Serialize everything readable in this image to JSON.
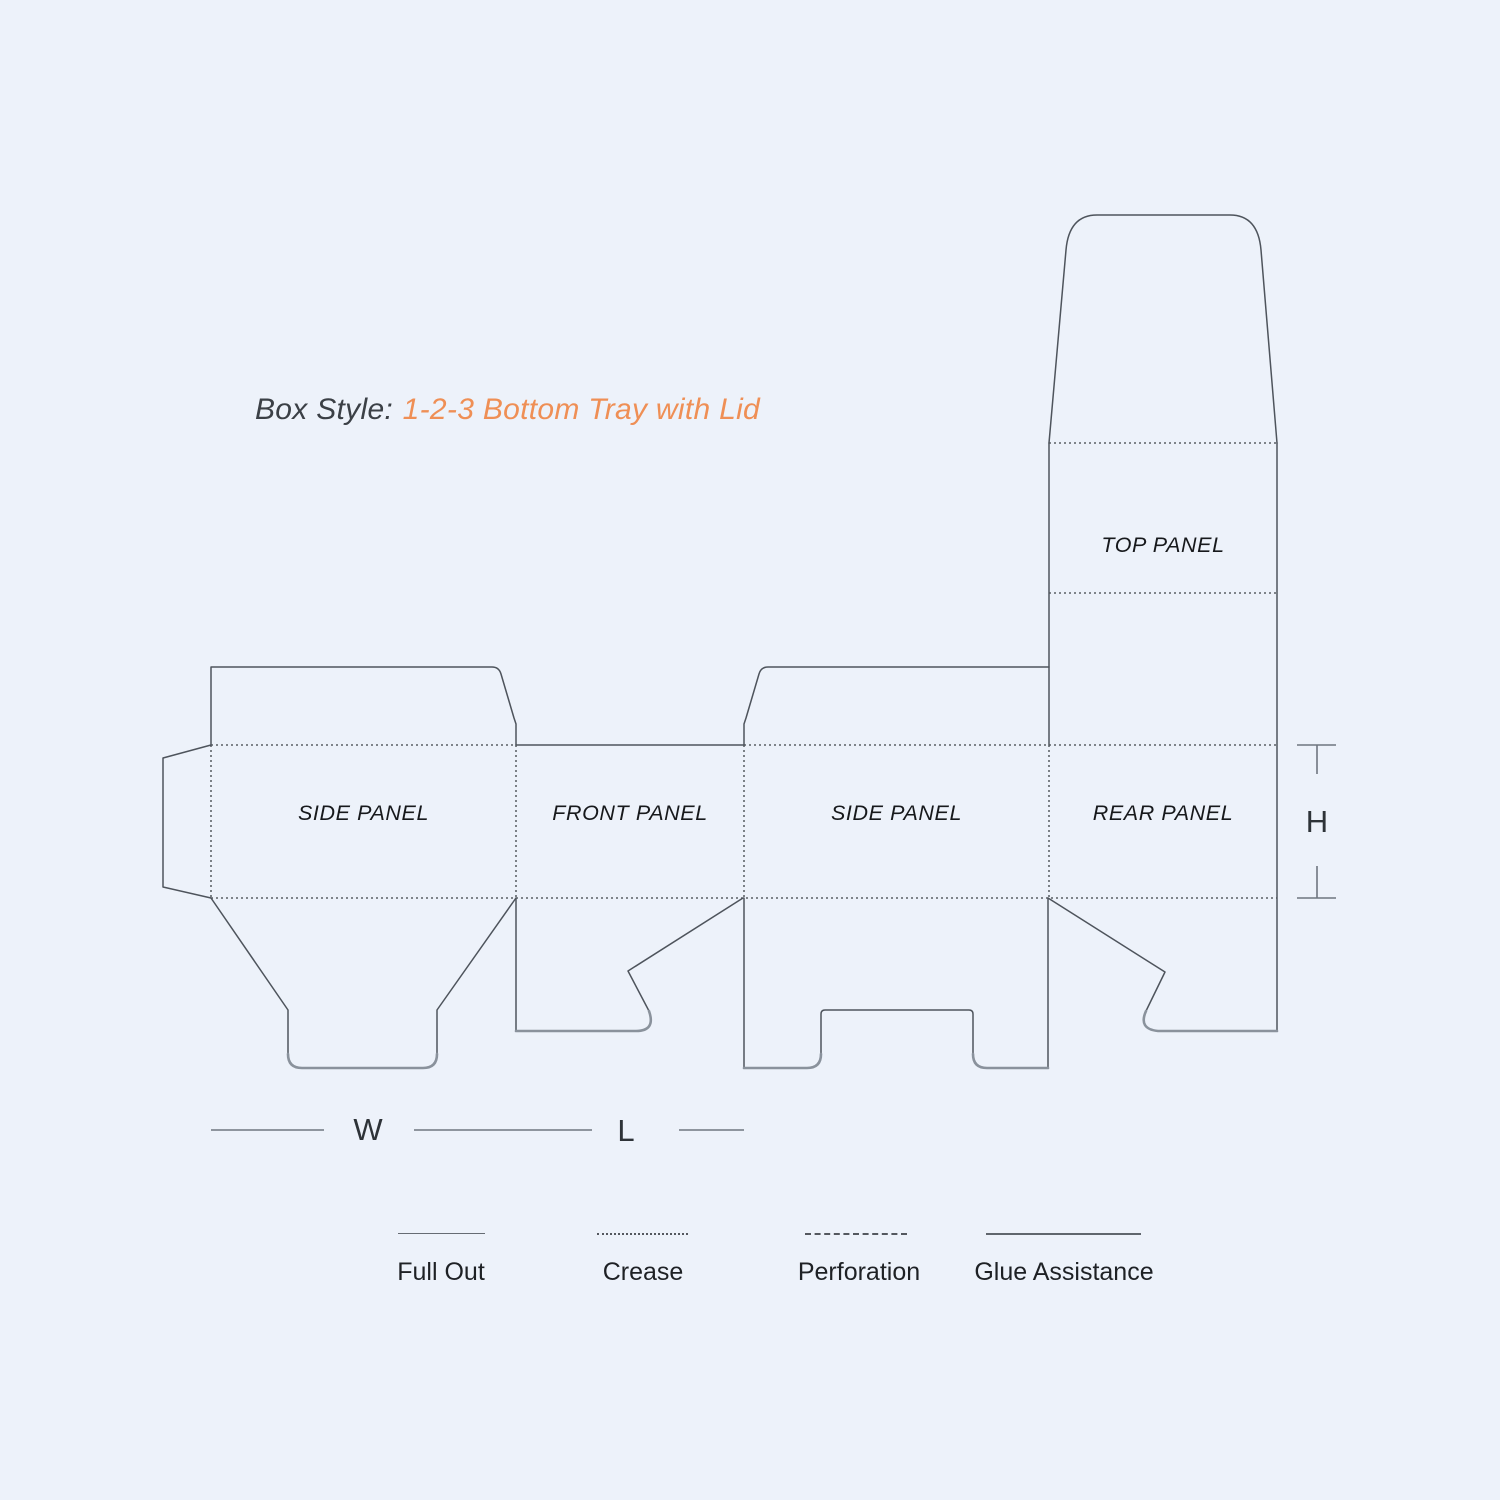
{
  "title": {
    "prefix": "Box Style:",
    "box_style": "1-2-3 Bottom Tray with Lid"
  },
  "panels": {
    "side1": "SIDE PANEL",
    "front": "FRONT PANEL",
    "side2": "SIDE PANEL",
    "rear": "REAR PANEL",
    "top": "TOP PANEL"
  },
  "dimensions": {
    "width_label": "W",
    "length_label": "L",
    "height_label": "H"
  },
  "legend": [
    {
      "id": "full-out",
      "label": "Full Out",
      "line_style": "thin solid"
    },
    {
      "id": "crease",
      "label": "Crease",
      "line_style": "dotted"
    },
    {
      "id": "perforation",
      "label": "Perforation",
      "line_style": "dashed"
    },
    {
      "id": "glue-assistance",
      "label": "Glue Assistance",
      "line_style": "solid"
    }
  ],
  "theme": {
    "bg": "#edf2fa",
    "cut-line": "#4e545c",
    "crease-line": "#3e4247",
    "glue-line": "#8a929c",
    "accent": "#ef8f55",
    "title-color": "#3b4046",
    "label-color": "#17191c",
    "dim-color": "#2e3338",
    "dim-line": "#6f7680",
    "legend-line": "#666c73",
    "legend-text": "#1e2125"
  }
}
